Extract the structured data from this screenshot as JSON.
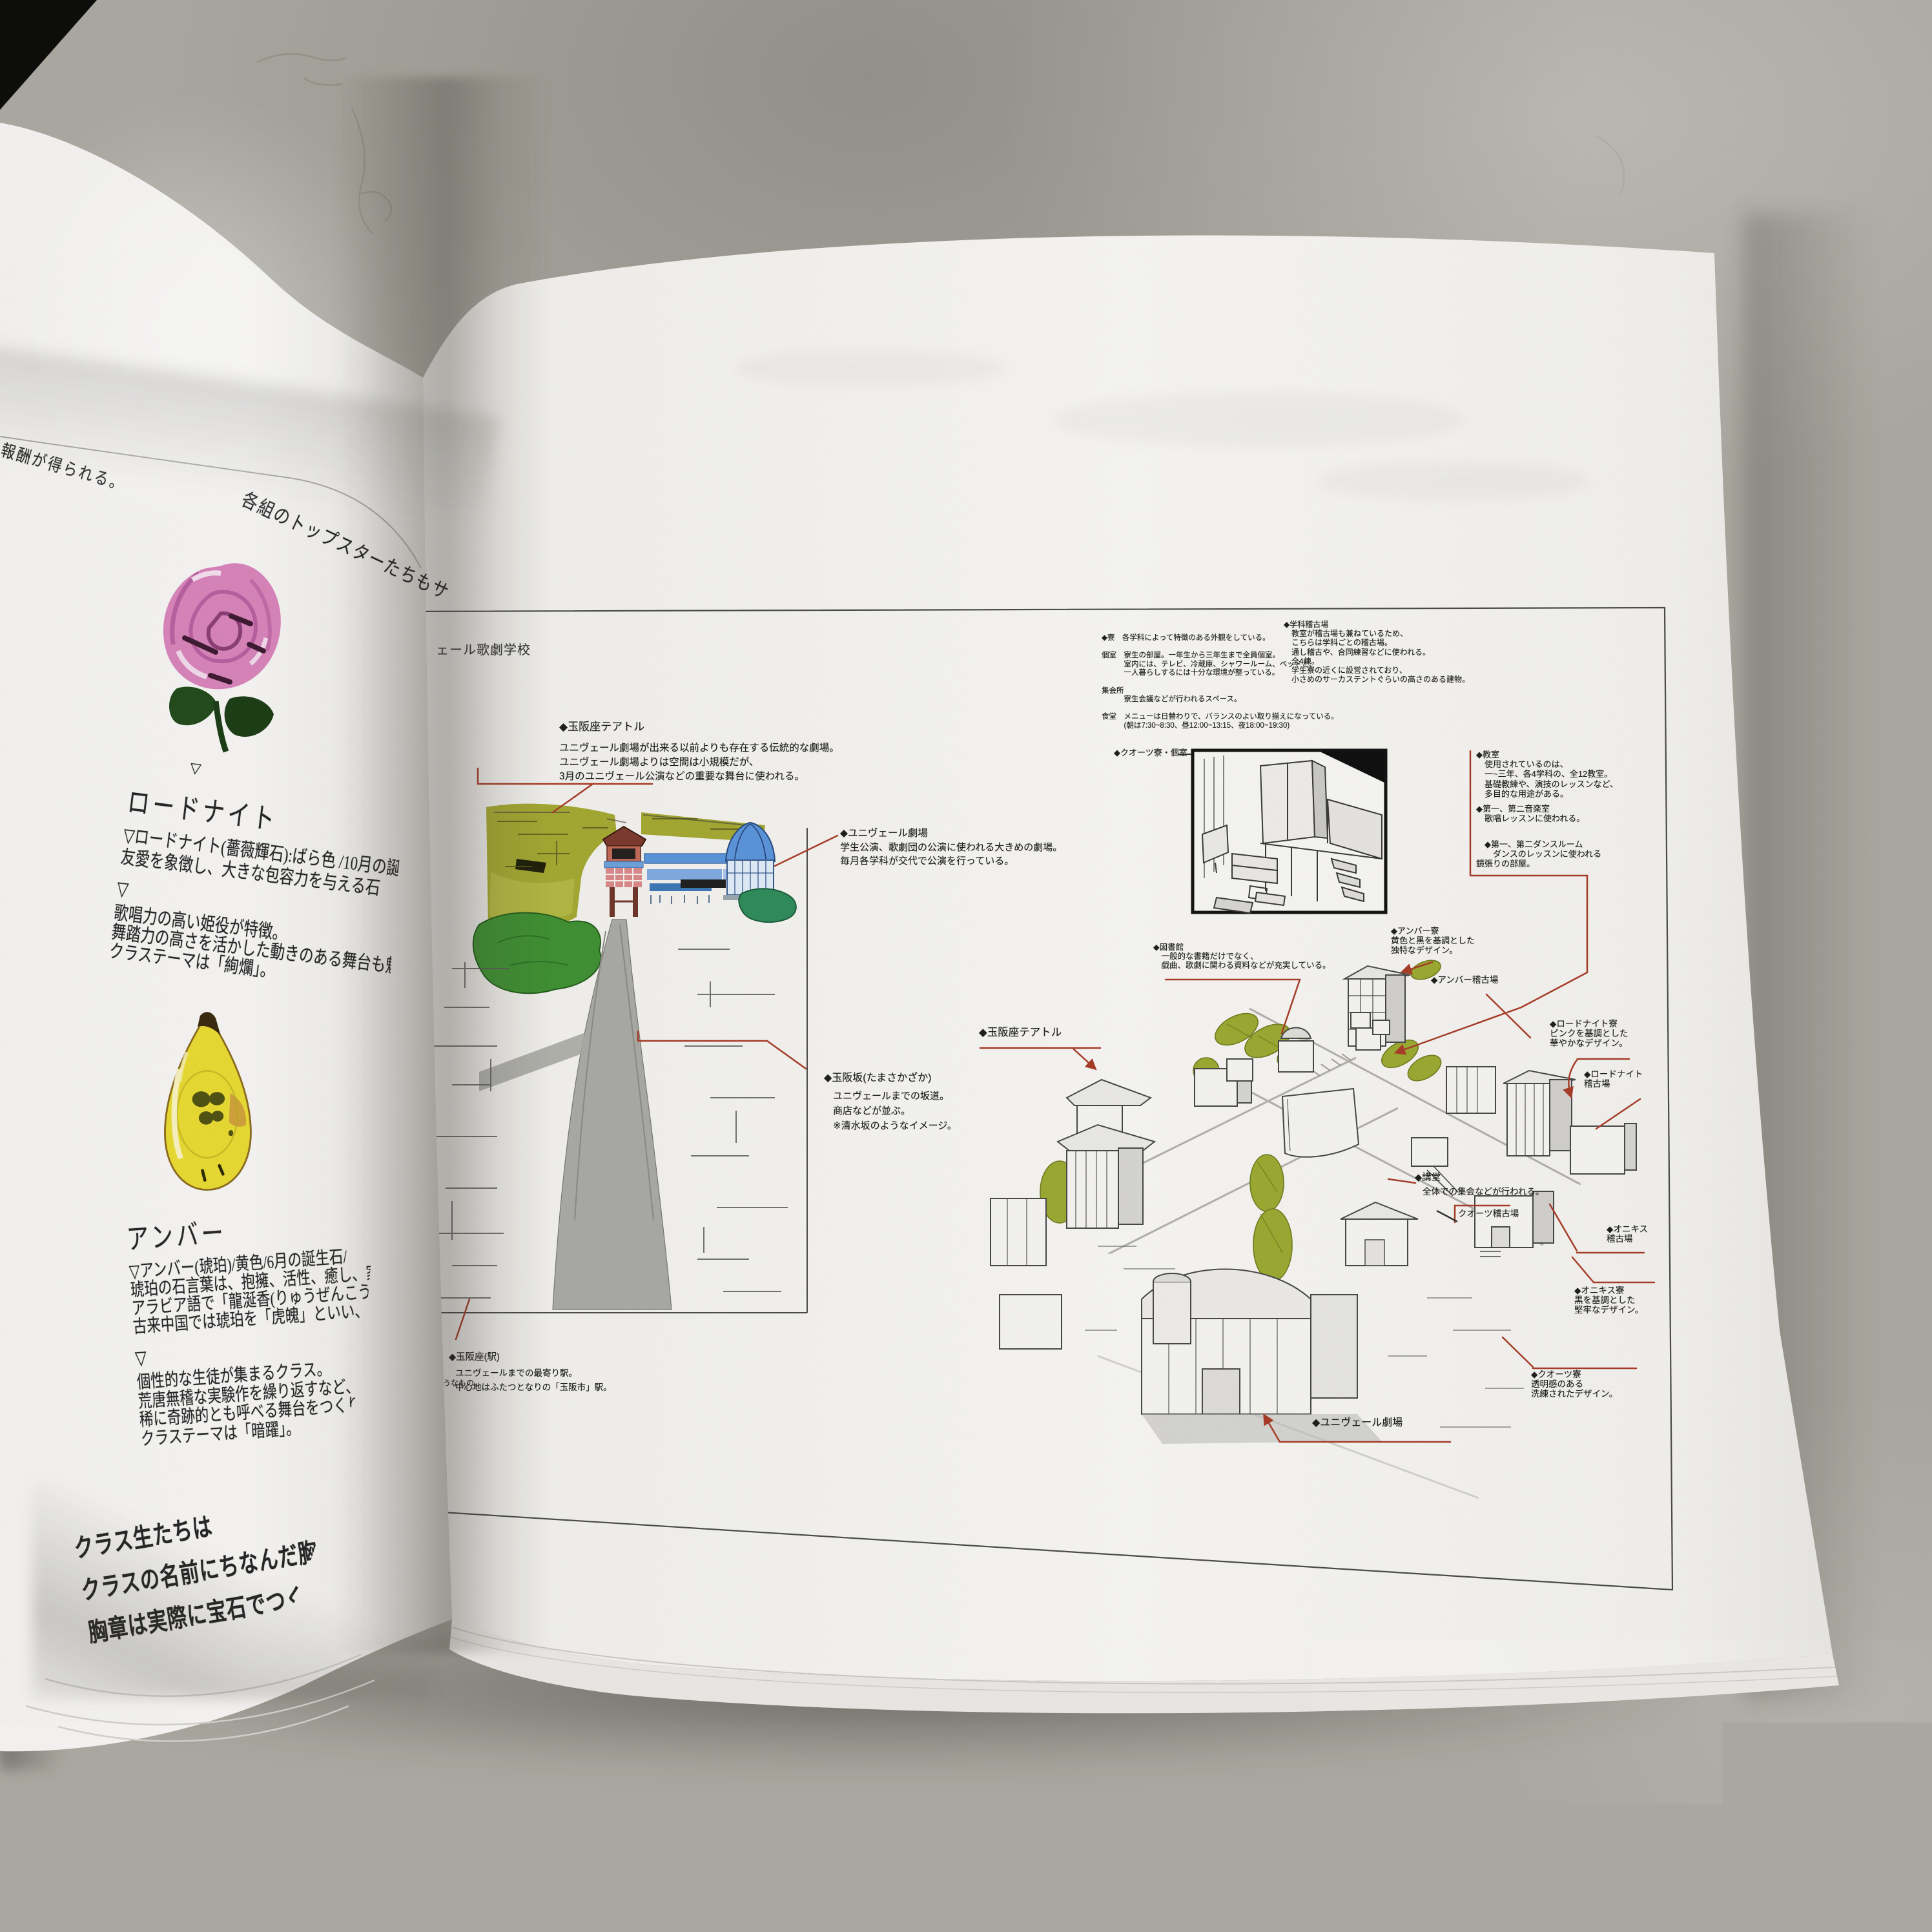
{
  "palette": {
    "concrete": "#a9a79f",
    "page_white": "#f2f1ee",
    "leader_red": "#a63c28",
    "hill_olive": "#a2a632",
    "leaf_green": "#3f8f33",
    "teal_green": "#2f8a5a",
    "banner_blue": "#5b93d8",
    "dome_blue": "#4a86c8",
    "rose_pink": "#d583b8",
    "amber_yellow": "#e6d832"
  },
  "left_page": {
    "top_note": "報酬が得られる。",
    "arc_note": "各組のトップスターたちもサブキャ",
    "rhodonite": {
      "pre_mark": "▽",
      "heading": "ロードナイト",
      "info_lines": [
        "▽ロードナイト(薔薇輝石):ばら色 /10月の誕生石/「",
        "友愛を象徴し、大きな包容力を与える石"
      ],
      "mark": "▽",
      "class_lines": [
        "歌唱力の高い姫役が特徴。",
        "舞踏力の高さを活かした動きのある舞台も魅力。",
        "クラステーマは「絢爛」。"
      ]
    },
    "amber": {
      "heading": "アンバー",
      "info_lines": [
        "▽アンバー(琥珀)/黄色/6月の誕生石/",
        "琥珀の石言葉は、抱擁、活性、癒し、家族の繁栄、長",
        "アラビア語で「龍涎香(りゅうぜんこう)」。",
        "古来中国では琥珀を「虎魄」といい、「琥珀は虎の"
      ],
      "mark": "▽",
      "class_lines": [
        "個性的な生徒が集まるクラス。",
        "荒唐無稽な実験作を繰り返すなど、賞レースに絡",
        "稀に奇跡的とも呼べる舞台をつくりあげ、伝説を",
        "クラステーマは「暗躍」。"
      ]
    },
    "footer_lines": [
      "クラス生たちは",
      "クラスの名前にちなんだ胸章を",
      "胸章は実際に宝石でつくられてい"
    ]
  },
  "right_page": {
    "header_partial": "ェール歌劇学校",
    "dorm_info_lines": [
      "◆寮　各学科によって特徴のある外観をしている。",
      "",
      "個室　寮生の部屋。一年生から三年生まで全員個室。",
      "　　　室内には、テレビ、冷蔵庫、シャワールーム、ベッドと、",
      "　　　一人暮らしするには十分な環境が整っている。",
      "",
      "集会所",
      "　　　寮生会議などが行われるスペース。",
      "",
      "食堂　メニューは日替わりで、バランスのよい取り揃えになっている。",
      "　　　(朝は7:30~8:30、昼12:00~13:15、夜18:00~19:30)"
    ],
    "gakka_keikoba_lines": [
      "◆学科稽古場",
      "　教室が稽古場も兼ねているため、",
      "　こちらは学科ごとの稽古場。",
      "　通し稽古や、合同練習などに使われる。",
      "　全4棟。",
      "　学生寮の近くに設営されており、",
      "　小さめのサーカステントぐらいの高さのある建物。"
    ],
    "tamasakaza_theatre": {
      "title": "◆玉阪座テアトル",
      "lines": [
        "ユニヴェール劇場が出来る以前よりも存在する伝統的な劇場。",
        "ユニヴェール劇場よりは空間は小規模だが、",
        "3月のユニヴェール公演などの重要な舞台に使われる。"
      ]
    },
    "univeil_theatre": {
      "title": "◆ユニヴェール劇場",
      "lines": [
        "学生公演、歌劇団の公演に使われる大きめの劇場。",
        "毎月各学科が交代で公演を行っている。"
      ]
    },
    "tamasakazaka": {
      "title": "◆玉阪坂(たまさかざか)",
      "lines": [
        "ユニヴェールまでの坂道。",
        "商店などが並ぶ。",
        "※清水坂のようなイメージ。"
      ]
    },
    "otomehiko_street": {
      "name": "乙女彦通",
      "reading": "(めひこどおり)",
      "lines": [
        "玉阪坂の脇道。",
        "玉阪坂を表通りと",
        "するなら、",
        "こちらは裏通りのようなもの。"
      ]
    },
    "tamasakaza_station": {
      "title": "◆玉阪座(駅)",
      "lines": [
        "ユニヴェールまでの最寄り駅。",
        "中心地はふたつとなりの「玉阪市」駅。"
      ]
    },
    "quartz_dorm_room_label": "◆クオーツ寮・個室",
    "classroom_lines": [
      "◆教室",
      "　使用されているのは、",
      "　一~三年、各4学科の、全12教室。",
      "　基礎教練や、演技のレッスンなど、",
      "　多目的な用途がある。"
    ],
    "music_room_lines": [
      "◆第一、第二音楽室",
      "　歌唱レッスンに使われる。"
    ],
    "dance_room_lines": [
      "　◆第一、第二ダンスルーム",
      "　　ダンスのレッスンに使われる",
      "鏡張りの部屋。"
    ],
    "library_lines": [
      "◆図書館",
      "　一般的な書籍だけでなく、",
      "　戯曲、歌劇に関わる資料などが充実している。"
    ],
    "amber_dorm_lines": [
      "◆アンバー寮",
      "黄色と黒を基調とした",
      "独特なデザイン。"
    ],
    "amber_keikoba_label": "◆アンバー稽古場",
    "rhodonite_dorm_lines": [
      "◆ロードナイト寮",
      "ピンクを基調とした",
      "華やかなデザイン。"
    ],
    "rhodonite_keikoba_lines": [
      "◆ロードナイト",
      "稽古場"
    ],
    "auditorium": {
      "title": "◆講堂",
      "desc": "全体での集会などが行われる。"
    },
    "quartz_keikoba_label": "クオーツ稽古場",
    "onyx_keikoba_lines": [
      "◆オニキス",
      "稽古場"
    ],
    "onyx_dorm_lines": [
      "◆オニキス寮",
      "黒を基調とした",
      "堅牢なデザイン。"
    ],
    "quartz_dorm_lines": [
      "◆クオーツ寮",
      "透明感のある",
      "洗練されたデザイン。"
    ],
    "map_univeil_theatre_label": "◆ユニヴェール劇場",
    "map_tamasakaza_theatre_label": "◆玉阪座テアトル"
  }
}
